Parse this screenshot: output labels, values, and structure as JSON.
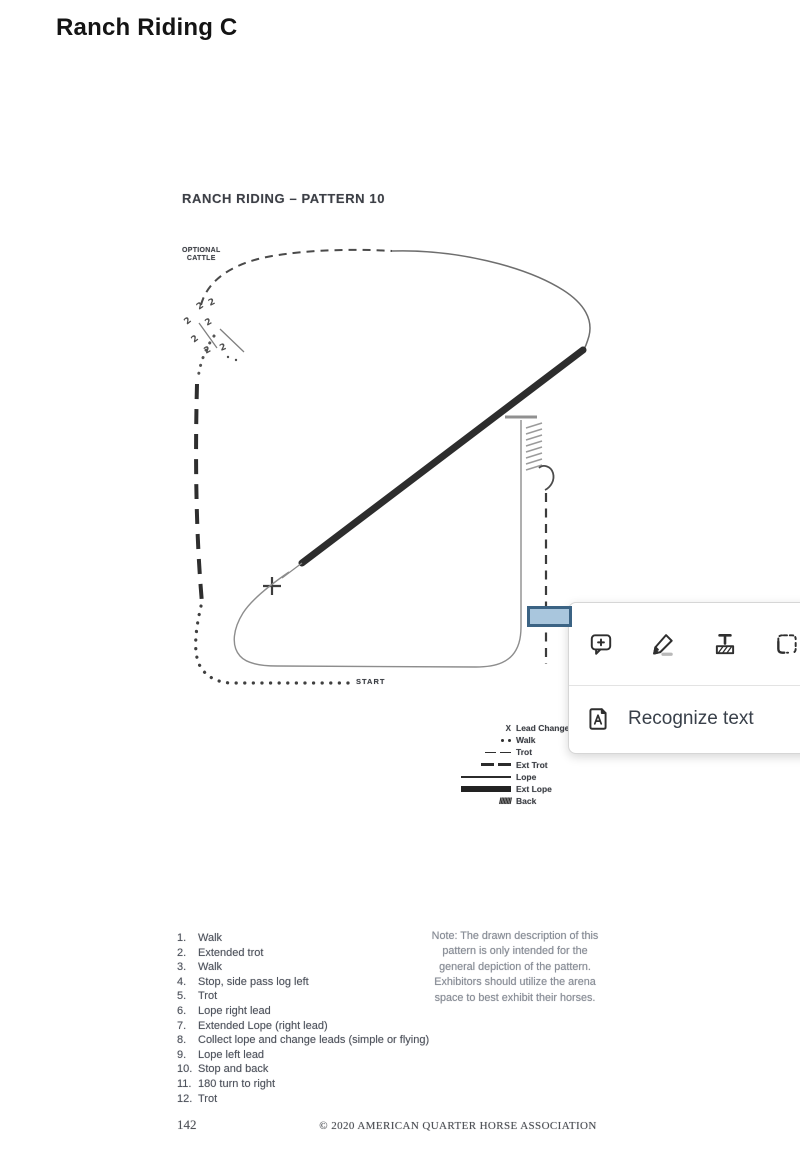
{
  "page": {
    "title": "Ranch Riding C"
  },
  "document": {
    "heading": "RANCH RIDING – PATTERN 10",
    "cattle_label_line1": "OPTIONAL",
    "cattle_label_line2": "CATTLE",
    "start_label": "START",
    "legend": {
      "items": [
        {
          "symbol": "x-marker",
          "symbol_char": "X",
          "label": "Lead Change"
        },
        {
          "symbol": "dots",
          "label": "Walk"
        },
        {
          "symbol": "thin-dashes",
          "label": "Trot"
        },
        {
          "symbol": "thick-dashes",
          "label": "Ext Trot"
        },
        {
          "symbol": "medium-line",
          "label": "Lope"
        },
        {
          "symbol": "thick-line",
          "label": "Ext Lope"
        },
        {
          "symbol": "hatch",
          "symbol_char": "////////",
          "label": "Back"
        }
      ]
    },
    "steps": [
      {
        "num": "1.",
        "text": "Walk"
      },
      {
        "num": "2.",
        "text": "Extended trot"
      },
      {
        "num": "3.",
        "text": "Walk"
      },
      {
        "num": "4.",
        "text": "Stop, side pass log left"
      },
      {
        "num": "5.",
        "text": "Trot"
      },
      {
        "num": "6.",
        "text": "Lope right lead"
      },
      {
        "num": "7.",
        "text": "Extended Lope (right lead)"
      },
      {
        "num": "8.",
        "text": "Collect lope and change leads (simple or flying)"
      },
      {
        "num": "9.",
        "text": "Lope left lead"
      },
      {
        "num": "10.",
        "text": "Stop and back"
      },
      {
        "num": "11.",
        "text": "180 turn to right"
      },
      {
        "num": "12.",
        "text": "Trot"
      }
    ],
    "note_lines": [
      "Note: The drawn description of this",
      "pattern is only intended for the",
      "general depiction of the pattern.",
      "Exhibitors should utilize the arena",
      "space to best exhibit their horses."
    ],
    "footer": {
      "page_number": "142",
      "copyright": "© 2020 AMERICAN QUARTER HORSE ASSOCIATION"
    }
  },
  "popup": {
    "tools": [
      {
        "name": "add-comment"
      },
      {
        "name": "draw-pen"
      },
      {
        "name": "highlight-text"
      },
      {
        "name": "snapshot-select"
      }
    ],
    "menu_item_label": "Recognize text"
  },
  "annotation": {
    "fill": "#a9c6dd",
    "border": "#3b6384"
  }
}
